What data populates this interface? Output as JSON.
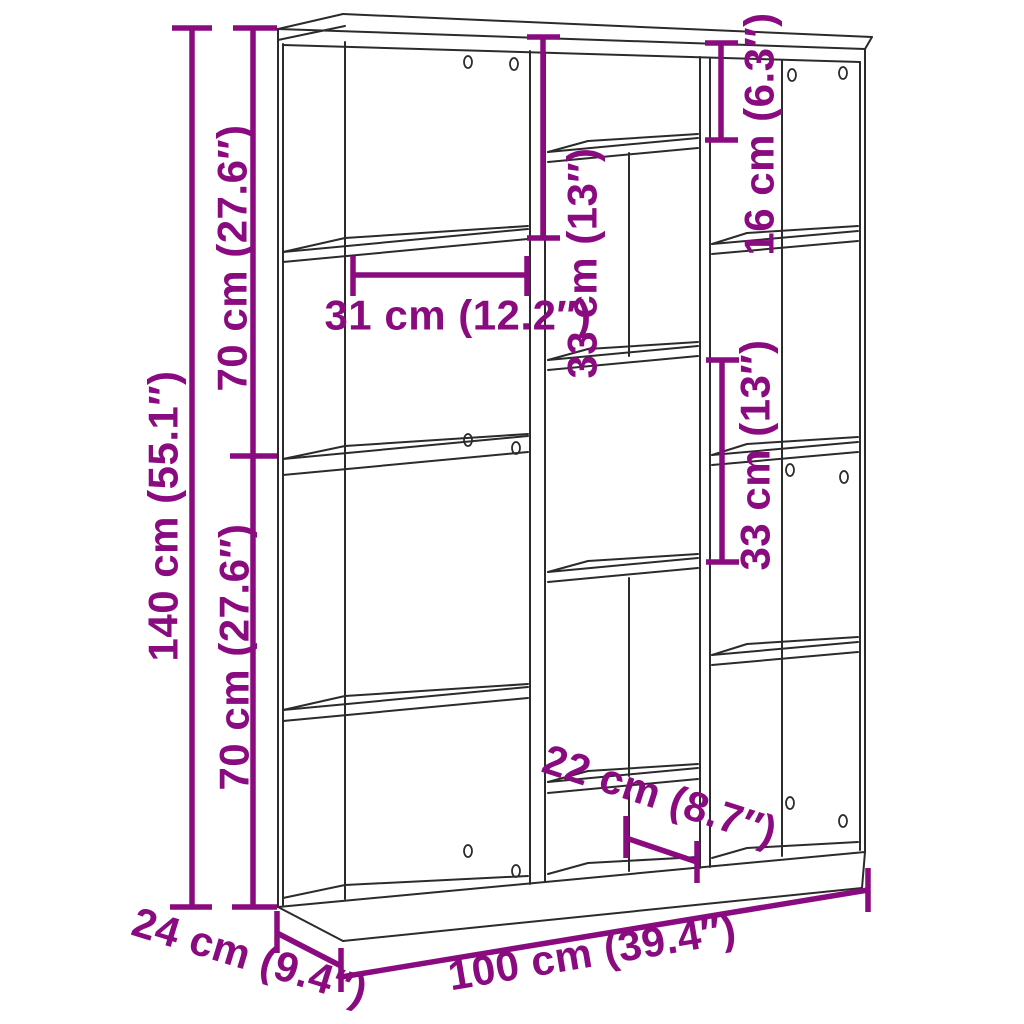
{
  "diagram_title": "bookshelf-dimension-diagram",
  "colors": {
    "dimension_accent": "#8a0a80",
    "drawing_line": "#2b2b2b",
    "background": "#ffffff"
  },
  "labels": {
    "height_total": "140 cm (55.1″)",
    "height_upper": "70 cm (27.6″)",
    "height_lower": "70 cm (27.6″)",
    "top_left_compartment_height": "33 cm (13″)",
    "top_right_compartment_height": "16 cm (6.3″)",
    "middle_compartment_height": "33 cm (13″)",
    "compartment_width": "31 cm (12.2″)",
    "bottom_cubby_width": "22 cm (8.7″)",
    "width_total": "100 cm (39.4″)",
    "depth_total": "24 cm (9.4″)"
  }
}
